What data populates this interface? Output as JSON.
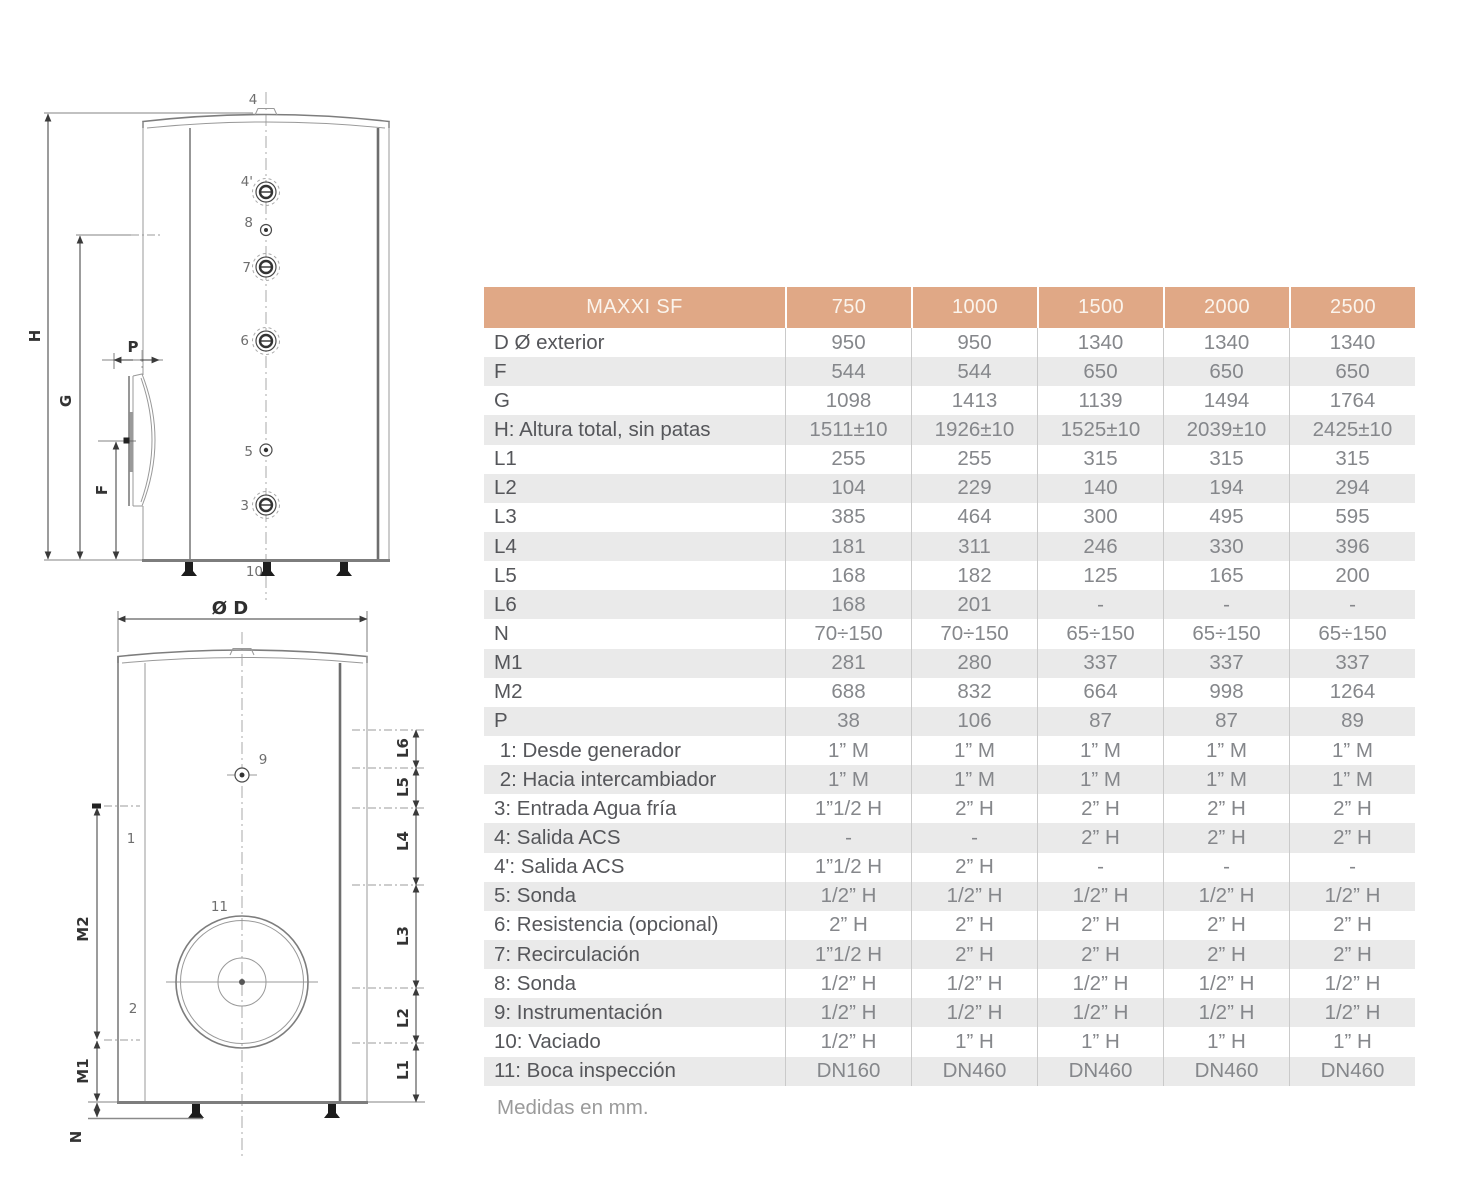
{
  "table": {
    "title": "MAXXI SF",
    "columns": [
      "750",
      "1000",
      "1500",
      "2000",
      "2500"
    ],
    "rows": [
      {
        "label": "D Ø exterior",
        "values": [
          "950",
          "950",
          "1340",
          "1340",
          "1340"
        ]
      },
      {
        "label": "F",
        "values": [
          "544",
          "544",
          "650",
          "650",
          "650"
        ]
      },
      {
        "label": "G",
        "values": [
          "1098",
          "1413",
          "1139",
          "1494",
          "1764"
        ]
      },
      {
        "label": "H: Altura total, sin patas",
        "values": [
          "1511±10",
          "1926±10",
          "1525±10",
          "2039±10",
          "2425±10"
        ]
      },
      {
        "label": "L1",
        "values": [
          "255",
          "255",
          "315",
          "315",
          "315"
        ]
      },
      {
        "label": "L2",
        "values": [
          "104",
          "229",
          "140",
          "194",
          "294"
        ]
      },
      {
        "label": "L3",
        "values": [
          "385",
          "464",
          "300",
          "495",
          "595"
        ]
      },
      {
        "label": "L4",
        "values": [
          "181",
          "311",
          "246",
          "330",
          "396"
        ]
      },
      {
        "label": "L5",
        "values": [
          "168",
          "182",
          "125",
          "165",
          "200"
        ]
      },
      {
        "label": "L6",
        "values": [
          "168",
          "201",
          "-",
          "-",
          "-"
        ]
      },
      {
        "label": "N",
        "values": [
          "70÷150",
          "70÷150",
          "65÷150",
          "65÷150",
          "65÷150"
        ]
      },
      {
        "label": "M1",
        "values": [
          "281",
          "280",
          "337",
          "337",
          "337"
        ]
      },
      {
        "label": "M2",
        "values": [
          "688",
          "832",
          "664",
          "998",
          "1264"
        ]
      },
      {
        "label": "P",
        "values": [
          "38",
          "106",
          "87",
          "87",
          "89"
        ]
      },
      {
        "label": " 1: Desde generador",
        "values": [
          "1” M",
          "1” M",
          "1” M",
          "1” M",
          "1” M"
        ]
      },
      {
        "label": " 2: Hacia intercambiador",
        "values": [
          "1” M",
          "1” M",
          "1” M",
          "1” M",
          "1” M"
        ]
      },
      {
        "label": "3: Entrada Agua fría",
        "values": [
          "1”1/2 H",
          "2” H",
          "2” H",
          "2” H",
          "2” H"
        ]
      },
      {
        "label": "4: Salida ACS",
        "values": [
          "-",
          "-",
          "2” H",
          "2” H",
          "2” H"
        ]
      },
      {
        "label": "4': Salida ACS",
        "values": [
          "1”1/2 H",
          "2” H",
          "-",
          "-",
          "-"
        ]
      },
      {
        "label": "5: Sonda",
        "values": [
          "1/2” H",
          "1/2” H",
          "1/2” H",
          "1/2” H",
          "1/2” H"
        ]
      },
      {
        "label": "6: Resistencia (opcional)",
        "values": [
          "2” H",
          "2” H",
          "2” H",
          "2” H",
          "2” H"
        ]
      },
      {
        "label": "7: Recirculación",
        "values": [
          "1”1/2 H",
          "2” H",
          "2” H",
          "2” H",
          "2” H"
        ]
      },
      {
        "label": "8: Sonda",
        "values": [
          "1/2” H",
          "1/2” H",
          "1/2” H",
          "1/2” H",
          "1/2” H"
        ]
      },
      {
        "label": "9: Instrumentación",
        "values": [
          "1/2” H",
          "1/2” H",
          "1/2” H",
          "1/2” H",
          "1/2” H"
        ]
      },
      {
        "label": "10: Vaciado",
        "values": [
          "1/2” H",
          "1” H",
          "1” H",
          "1” H",
          "1” H"
        ]
      },
      {
        "label": "11: Boca inspección",
        "values": [
          "DN160",
          "DN460",
          "DN460",
          "DN460",
          "DN460"
        ]
      }
    ],
    "footnote": "Medidas en mm.",
    "colors": {
      "header_bg": "#E0A886",
      "header_text": "#FBF4EC",
      "row_alt_bg": "#EAEAEA",
      "label_text": "#55565A",
      "value_text": "#85878B"
    }
  },
  "diagram": {
    "front_view": {
      "labels": {
        "c4": "4",
        "c4p": "4'",
        "c8": "8",
        "c7": "7",
        "c6": "6",
        "c5": "5",
        "c3": "3",
        "c10": "10",
        "dim_h": "H",
        "dim_g": "G",
        "dim_f": "F",
        "dim_p": "P"
      }
    },
    "bottom_view": {
      "labels": {
        "dim_d": "Ø D",
        "c9": "9",
        "c1": "1",
        "c2": "2",
        "c11": "11",
        "dim_m2": "M2",
        "dim_m1": "M1",
        "dim_n": "N",
        "dim_l6": "L6",
        "dim_l5": "L5",
        "dim_l4": "L4",
        "dim_l3": "L3",
        "dim_l2": "L2",
        "dim_l1": "L1"
      }
    }
  }
}
